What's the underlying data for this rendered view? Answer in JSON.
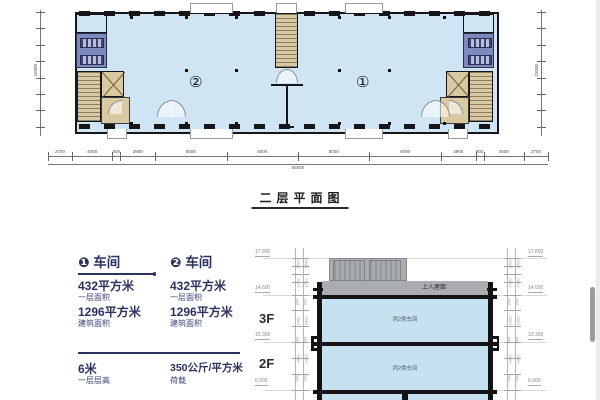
{
  "colors": {
    "plan_fill": "#cfe5f3",
    "wet_fill": "#7e89bd",
    "stair_fill": "#d9c9a2",
    "section_fill": "#c6e2f0",
    "roof_gray": "#a9acb0",
    "ink": "#15151a",
    "navy": "#2a325f"
  },
  "plan": {
    "title": "二层平面图",
    "unit1_mark": "①",
    "unit2_mark": "②",
    "bottom_dims": [
      "2700",
      "4500",
      "900",
      "3900",
      "8000",
      "8000",
      "8000",
      "8000",
      "3900",
      "900",
      "4500",
      "2700"
    ],
    "bottom_total": "56000",
    "side_total": "15000"
  },
  "specs": {
    "unit1": {
      "badge": "❶",
      "title": "车间",
      "rows": [
        {
          "value": "432平方米",
          "label": "一层面积"
        },
        {
          "value": "1296平方米",
          "label": "建筑面积"
        }
      ]
    },
    "unit2": {
      "badge": "❷",
      "title": "车间",
      "rows": [
        {
          "value": "432平方米",
          "label": "一层面积"
        },
        {
          "value": "1296平方米",
          "label": "建筑面积"
        }
      ]
    },
    "footer": [
      {
        "value": "6米",
        "label": "一层层高"
      },
      {
        "value": "350公斤/平方米",
        "label": "荷载"
      }
    ]
  },
  "section": {
    "roof_label": "上人屋面",
    "floor3_label": "3F",
    "floor2_label": "2F",
    "room_label": "丙2类车间",
    "elev_left": [
      "17.800",
      "14.600",
      "10.300",
      "6.000"
    ],
    "elev_right": [
      "17.800",
      "14.600",
      "10.300",
      "6.000"
    ],
    "stack_dims": [
      "1500",
      "1700",
      "900",
      "3400",
      "900",
      "3400",
      "900"
    ]
  }
}
